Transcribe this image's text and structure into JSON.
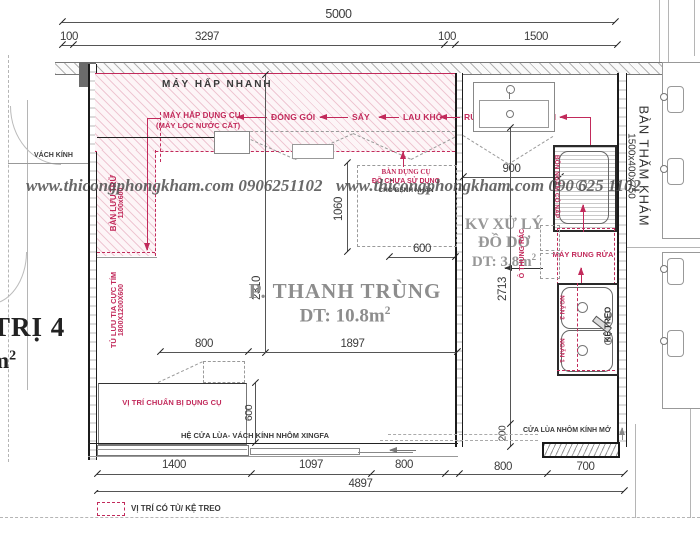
{
  "colors": {
    "accent_red": "#c22a5b",
    "title_gray": "#8d8d8d",
    "wall_black": "#1c1c1c"
  },
  "watermarks": {
    "left": "www.thicongphongkham.com   0906251102",
    "right": "www.thicongphongkham.com  090 625 1102"
  },
  "rooms": {
    "main_name": "P. THANH TRÙNG",
    "main_area": "DT: 10.8m",
    "dirty_1": "KV XỬ LÝ",
    "dirty_2": "ĐỒ DƠ",
    "dirty_area": "DT: 3.8m",
    "left_name": "TRỊ 4",
    "left_area": "m",
    "sup": "2"
  },
  "labels": {
    "may_hap_nhanh": "MÁY HẤP NHANH",
    "may_hap_dung_cu": "MÁY HẤP DỤNG CỤ",
    "may_loc_nuoc_cat": "(MÁY LỌC NƯỚC CẤT)",
    "dong_goi": "ĐÓNG GÓI",
    "say": "SẤY",
    "lau_kho": "LAU KHÔ",
    "rua_lai_nuoc_sach": "RỬA LẠI NƯỚC SẠCH",
    "vach_kinh": "VÁCH KÍNH",
    "ban_luu_tru": "BÀN LƯU TRỮ",
    "ban_luu_tru_size": "1100x600",
    "tu_luu_tia": "TỦ LƯU TIA CỰC TÍM",
    "tu_luu_tia_size": "1800X1200X600",
    "ban_dung_cu_1": "BÀN DỤNG CỤ",
    "ban_dung_cu_2": "ĐỒ CHƯA SỬ DỤNG",
    "ban_dung_cu_3": "CHO BỆNH NHÂN",
    "bon_ngam_co_nap": "BỒN NGÂM CÓ NẮP",
    "o_thung_rac": "Ô THÙNG RÁC",
    "may_rung_rua": "MÁY RUNG RỬA",
    "ngan_2": "NGĂN 2",
    "ngan_1": "NGĂN 1",
    "ke_treo": "KỆ TREO",
    "vi_tri_chuan_bi": "VỊ TRÍ CHUẨN BỊ DỤNG CỤ",
    "he_cua_lua": "HỆ CỬA LÙA- VÁCH KÍNH NHÔM XINGFA",
    "cua_lua_nhom": "CỬA LÙA NHÔM KÍNH MỞ",
    "ban_tham_kham": "BÀN THĂM KHÁM",
    "ban_tham_kham_size": "1500x400x750",
    "legend": "VỊ TRÍ CÓ TỦ/ KỆ TREO"
  },
  "dims": {
    "total_top": "5000",
    "t100a": "100",
    "t3297": "3297",
    "t100b": "100",
    "t1500": "1500",
    "v2310": "2310",
    "v1060": "1060",
    "v2713": "2713",
    "v200": "200",
    "v600": "600",
    "h900": "900",
    "h600": "600",
    "h800": "800",
    "h1897": "1897",
    "b1400": "1400",
    "b1097": "1097",
    "b800a": "800",
    "b800b": "800",
    "b700": "700",
    "total_bottom": "4897"
  }
}
